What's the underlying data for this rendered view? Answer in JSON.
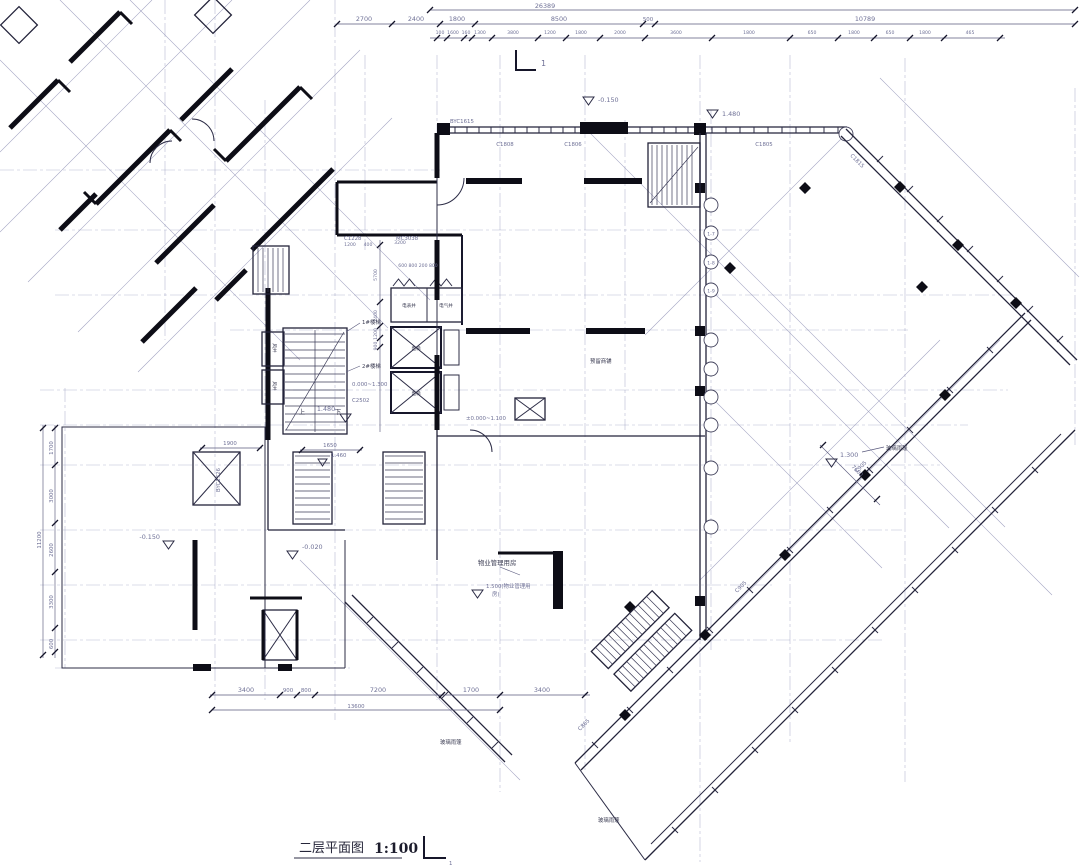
{
  "drawing": {
    "title": "二层平面图",
    "scale": "1:100",
    "section_mark": "1"
  },
  "dims": {
    "top_overall": "26389",
    "top_row2": [
      "2700",
      "2400",
      "1800",
      "8500",
      "500",
      "10789"
    ],
    "top_row3": [
      "100",
      "1600",
      "160",
      "1300",
      "3800",
      "1200",
      "1800",
      "2000",
      "3600",
      "1800",
      "650",
      "1800",
      "650",
      "1800",
      "465"
    ],
    "left_overall": "11200",
    "left_chain": [
      "1700",
      "3000",
      "2600",
      "3300",
      "600"
    ],
    "bottom_chain": [
      "3400",
      "900",
      "800",
      "7200",
      "1700",
      "3400"
    ],
    "bottom_overall": "13600",
    "core_vertical": [
      "5700",
      "2400",
      "1200",
      "900"
    ],
    "core_top": [
      "1200",
      "400",
      "3200"
    ],
    "core_top_small": "600 800 200 800",
    "hall": [
      "1900",
      "1650"
    ],
    "right_wing": "7600"
  },
  "levels": {
    "neg_0150": "-0.150",
    "neg_0020": "-0.020",
    "pos_1480": "1.480",
    "pos_1300": "1.300",
    "pos_1460": "1.460",
    "prop_line1": "1.500(物业管理用",
    "prop_line2": "房)",
    "range_core": "0.000~1.300",
    "range_hall": "±0.000~1.100"
  },
  "tags": {
    "byc1615": "BYC1615",
    "c1808": "C1808",
    "c1806": "C1806",
    "c1805": "C1805",
    "c1815": "C1815",
    "c905": "C905",
    "c865": "C865",
    "c2502": "C2502",
    "c1228": "C1228",
    "mc3038": "MC3038",
    "byc1726": "BYC1726"
  },
  "rooms": {
    "meter_shaft": "电表井",
    "elec_shaft": "电气井",
    "air_shaft": "风井",
    "elevator": "电梯",
    "property": "物业管理用房",
    "canopy": "玻璃雨篷",
    "retail": "预留商铺"
  },
  "stairs": {
    "s1": "1#楼梯",
    "s2": "2#楼梯",
    "up": "上",
    "down": "下"
  },
  "grid_bubbles": [
    "1-7",
    "1-8",
    "1-9"
  ]
}
